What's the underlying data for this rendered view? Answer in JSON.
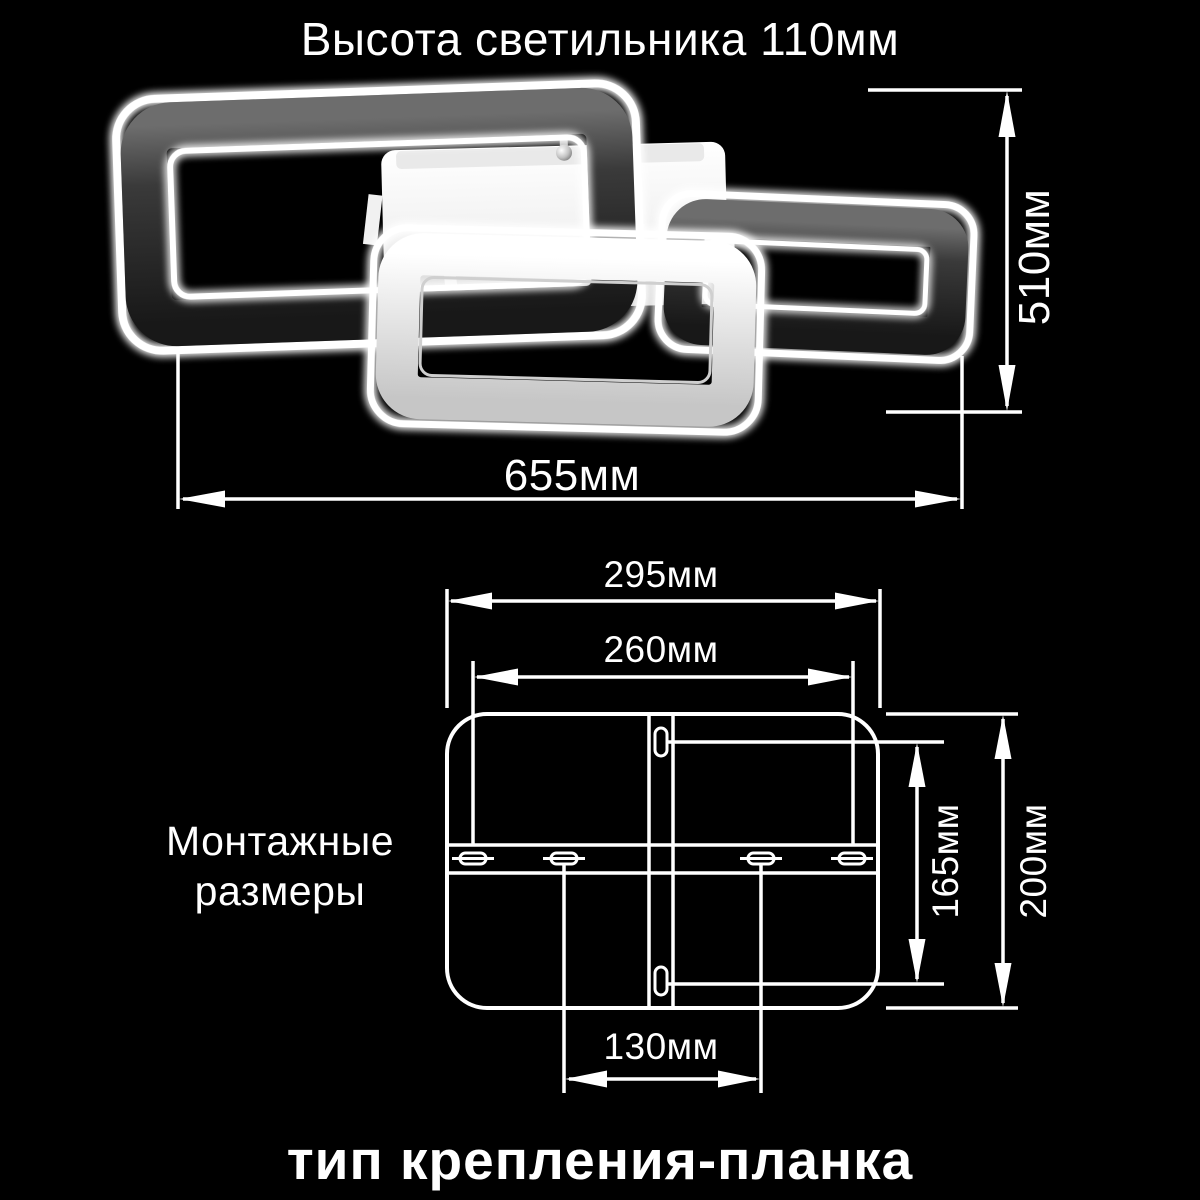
{
  "colors": {
    "background": "#000000",
    "line": "#ffffff",
    "text": "#ffffff",
    "frame_dark": "#2e2e2e",
    "frame_light": "#f5f5f5"
  },
  "header": {
    "title": "Высота светильника 110мм"
  },
  "fixture": {
    "width_label": "655мм",
    "height_label": "510мм"
  },
  "mounting": {
    "heading_line1": "Монтажные",
    "heading_line2": "размеры",
    "outer_width_label": "295мм",
    "slot_span_label": "260мм",
    "slot_height_label": "165мм",
    "outer_height_label": "200мм",
    "center_slot_label": "130мм"
  },
  "footer": {
    "caption": "тип крепления-планка"
  }
}
